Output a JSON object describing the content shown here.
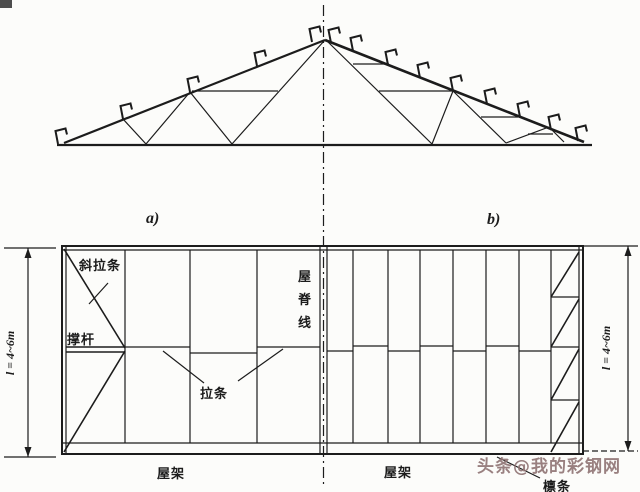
{
  "elevation": {
    "panel_a_label": "a)",
    "panel_b_label": "b)"
  },
  "plan": {
    "diagonal_tie_label": "斜拉条",
    "strut_label": "撑杆",
    "ridge_line_label": "屋脊线",
    "tie_label": "拉条",
    "truss_label_left": "屋架",
    "truss_label_right": "屋架",
    "purlin_label": "檩条",
    "dim_left": "l = 4~6m",
    "dim_right": "l = 4~6m"
  },
  "watermark": {
    "text": "头条@我的彩钢网",
    "color": "#8f7373"
  },
  "colors": {
    "ink": "#1c1c1c",
    "paper": "#fcfcfa"
  }
}
